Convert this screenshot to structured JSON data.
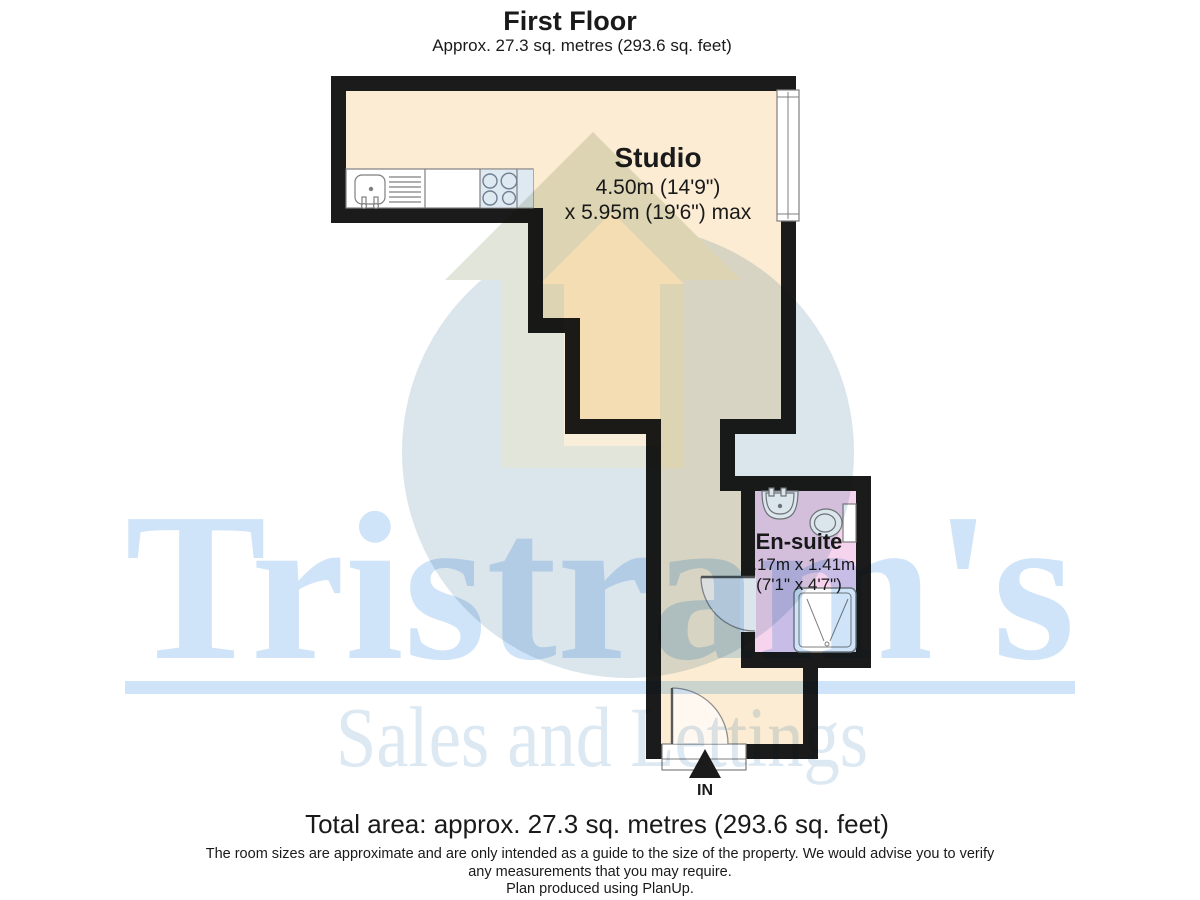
{
  "header": {
    "title": "First Floor",
    "subtitle": "Approx. 27.3 sq. metres (293.6 sq. feet)"
  },
  "rooms": {
    "studio": {
      "name": "Studio",
      "dim_line1": "4.50m (14'9\")",
      "dim_line2": "x 5.95m (19'6\") max"
    },
    "ensuite": {
      "name": "En-suite",
      "dim_line1": "2.17m x 1.41m",
      "dim_line2": "(7'1\" x 4'7\")"
    }
  },
  "entrance": {
    "label": "IN"
  },
  "watermark": {
    "brand": "Tristram's",
    "tagline": "Sales and Lettings"
  },
  "footer": {
    "total_area": "Total area: approx. 27.3 sq. metres (293.6 sq. feet)",
    "disclaimer_line1": "The room sizes are approximate and are only intended as a guide to the size of the property. We would advise you to verify",
    "disclaimer_line2": "any measurements that you may require.",
    "disclaimer_line3": "Plan produced using PlanUp."
  },
  "colors": {
    "wall": "#1b1b1b",
    "floor_cream": "#fbecd3",
    "ensuite_pink": "#f6d4ee",
    "fixture_stroke": "#7f7f7f",
    "hob_tint": "#dfe9f1",
    "watermark_circle": "#dbe5ec",
    "watermark_house_grey": "#e1e5da",
    "watermark_house_cream": "#f8eed9",
    "brand_blue": "#cfe4f8",
    "tagline_blue": "#dce8f2"
  }
}
